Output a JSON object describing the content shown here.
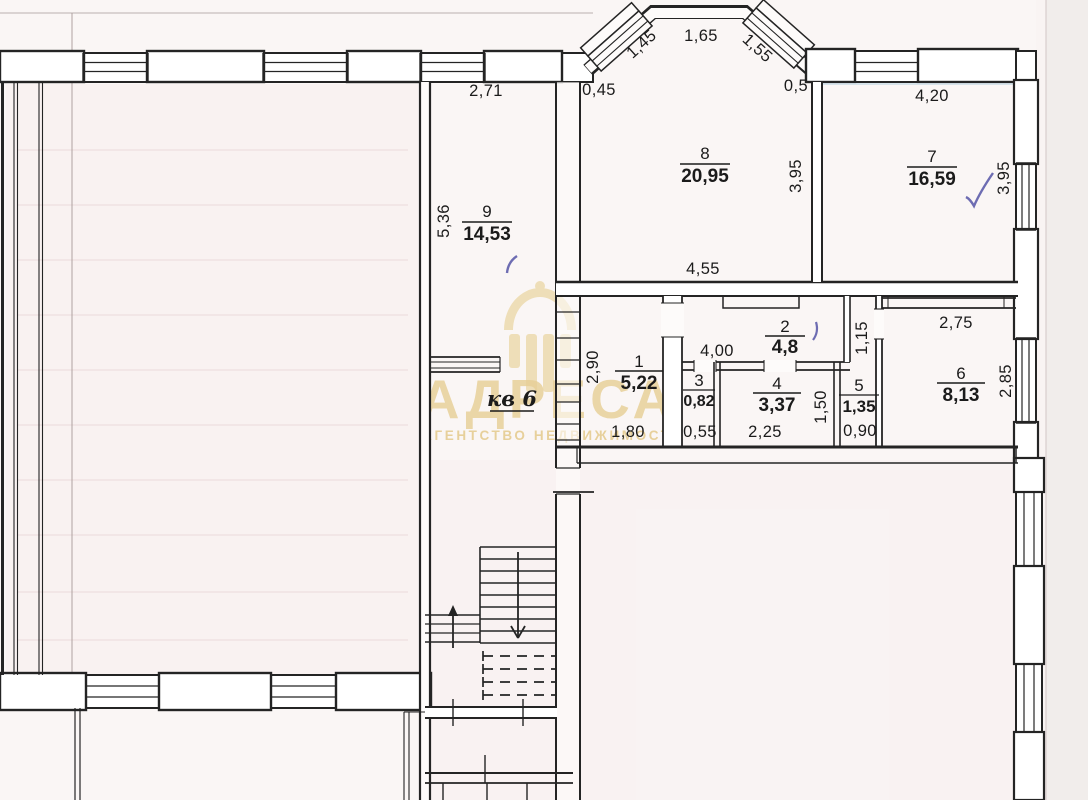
{
  "plan": {
    "apartment_label": "кв 6",
    "rooms": {
      "r1": {
        "number": "1",
        "area": "5,22"
      },
      "r2": {
        "number": "2",
        "area": "4,8"
      },
      "r3": {
        "number": "3",
        "area": "0,82"
      },
      "r4": {
        "number": "4",
        "area": "3,37"
      },
      "r5": {
        "number": "5",
        "area": "1,35"
      },
      "r6": {
        "number": "6",
        "area": "8,13"
      },
      "r7": {
        "number": "7",
        "area": "16,59"
      },
      "r8": {
        "number": "8",
        "area": "20,95"
      },
      "r9": {
        "number": "9",
        "area": "14,53"
      }
    },
    "dims": {
      "top_left": "2,71",
      "bay_left_offset": "0,45",
      "bay_win_left": "1,45",
      "bay_top": "1,65",
      "bay_win_right": "1,55",
      "bay_right_offset": "0,5",
      "room7_width": "4,20",
      "room78_height": "3,95",
      "room7_right_height": "3,95",
      "room8_bottom": "4,55",
      "room9_height": "5,36",
      "room6_top": "2,75",
      "room6_right": "2,85",
      "duct_height": "1,15",
      "room1_height": "2,90",
      "hall_width": "4,00",
      "room1_width": "1,80",
      "room3_width": "0,55",
      "room4_width": "2,25",
      "room4_height": "1,50",
      "room5_width": "0,90"
    }
  },
  "watermark": {
    "brand": "АДРЕСА",
    "subtitle": "АГЕНТСТВО НЕДВИЖИМОСТИ",
    "color": "#e7cf97"
  },
  "annotations": {
    "pen_color": "#5d5dab"
  }
}
